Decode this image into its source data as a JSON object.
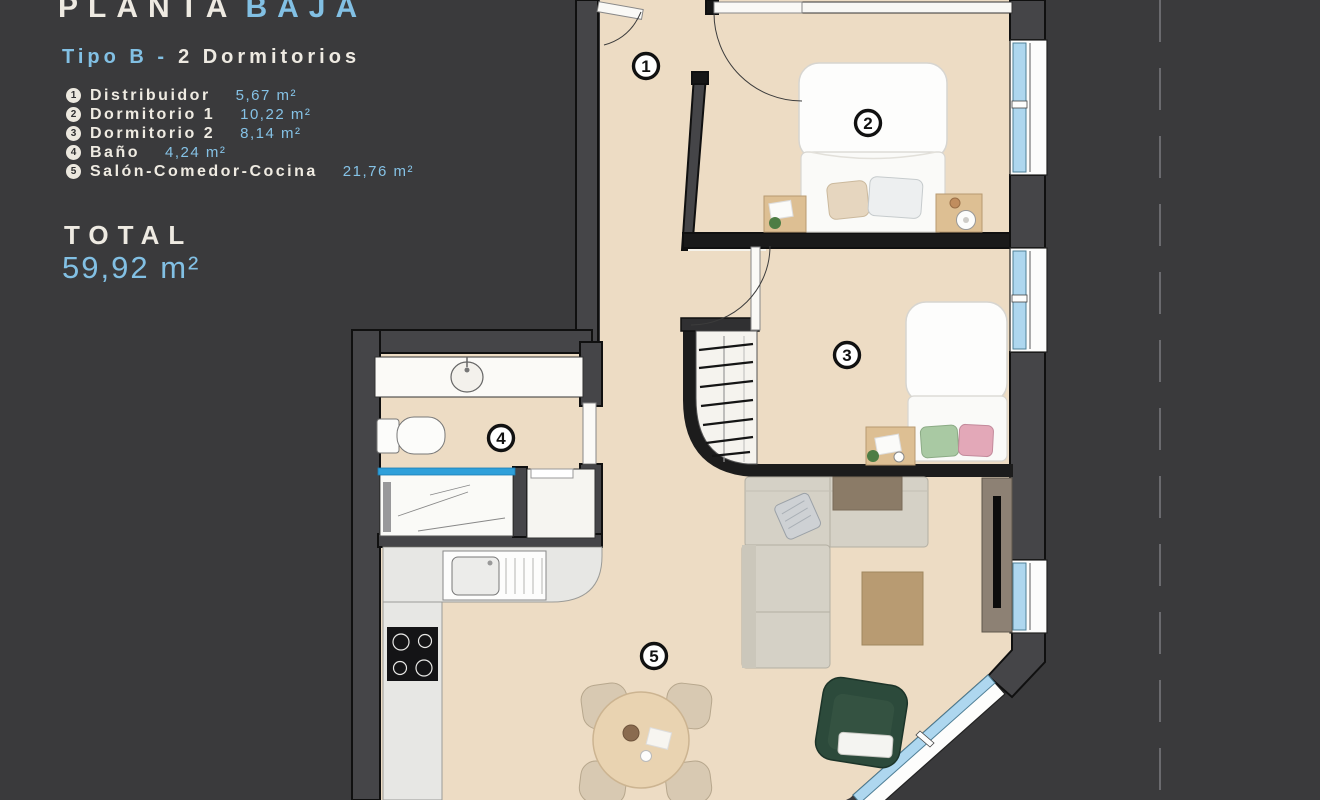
{
  "panel": {
    "title": {
      "part1": "PLANTA",
      "part2": "BAJA"
    },
    "subtitle": {
      "part1": "Tipo B -",
      "part2": "2 Dormitorios"
    },
    "legend": [
      {
        "num": "1",
        "name": "Distribuidor",
        "area": "5,67 m²"
      },
      {
        "num": "2",
        "name": "Dormitorio 1",
        "area": "10,22 m²"
      },
      {
        "num": "3",
        "name": "Dormitorio 2",
        "area": "8,14 m²"
      },
      {
        "num": "4",
        "name": "Baño",
        "area": "4,24 m²"
      },
      {
        "num": "5",
        "name": "Salón-Comedor-Cocina",
        "area": "21,76 m²"
      }
    ],
    "total": {
      "label": "TOTAL",
      "value": "59,92 m²"
    }
  },
  "plan": {
    "markers": [
      {
        "num": "1"
      },
      {
        "num": "2"
      },
      {
        "num": "3"
      },
      {
        "num": "4"
      },
      {
        "num": "5"
      }
    ]
  },
  "colors": {
    "background": "#3a3a3c",
    "accent_blue": "#82c0e4",
    "cream": "#eeeae2",
    "floor": "#eddcc4",
    "window_glass": "#aed7ef",
    "shower_glass": "#2fa0da"
  }
}
